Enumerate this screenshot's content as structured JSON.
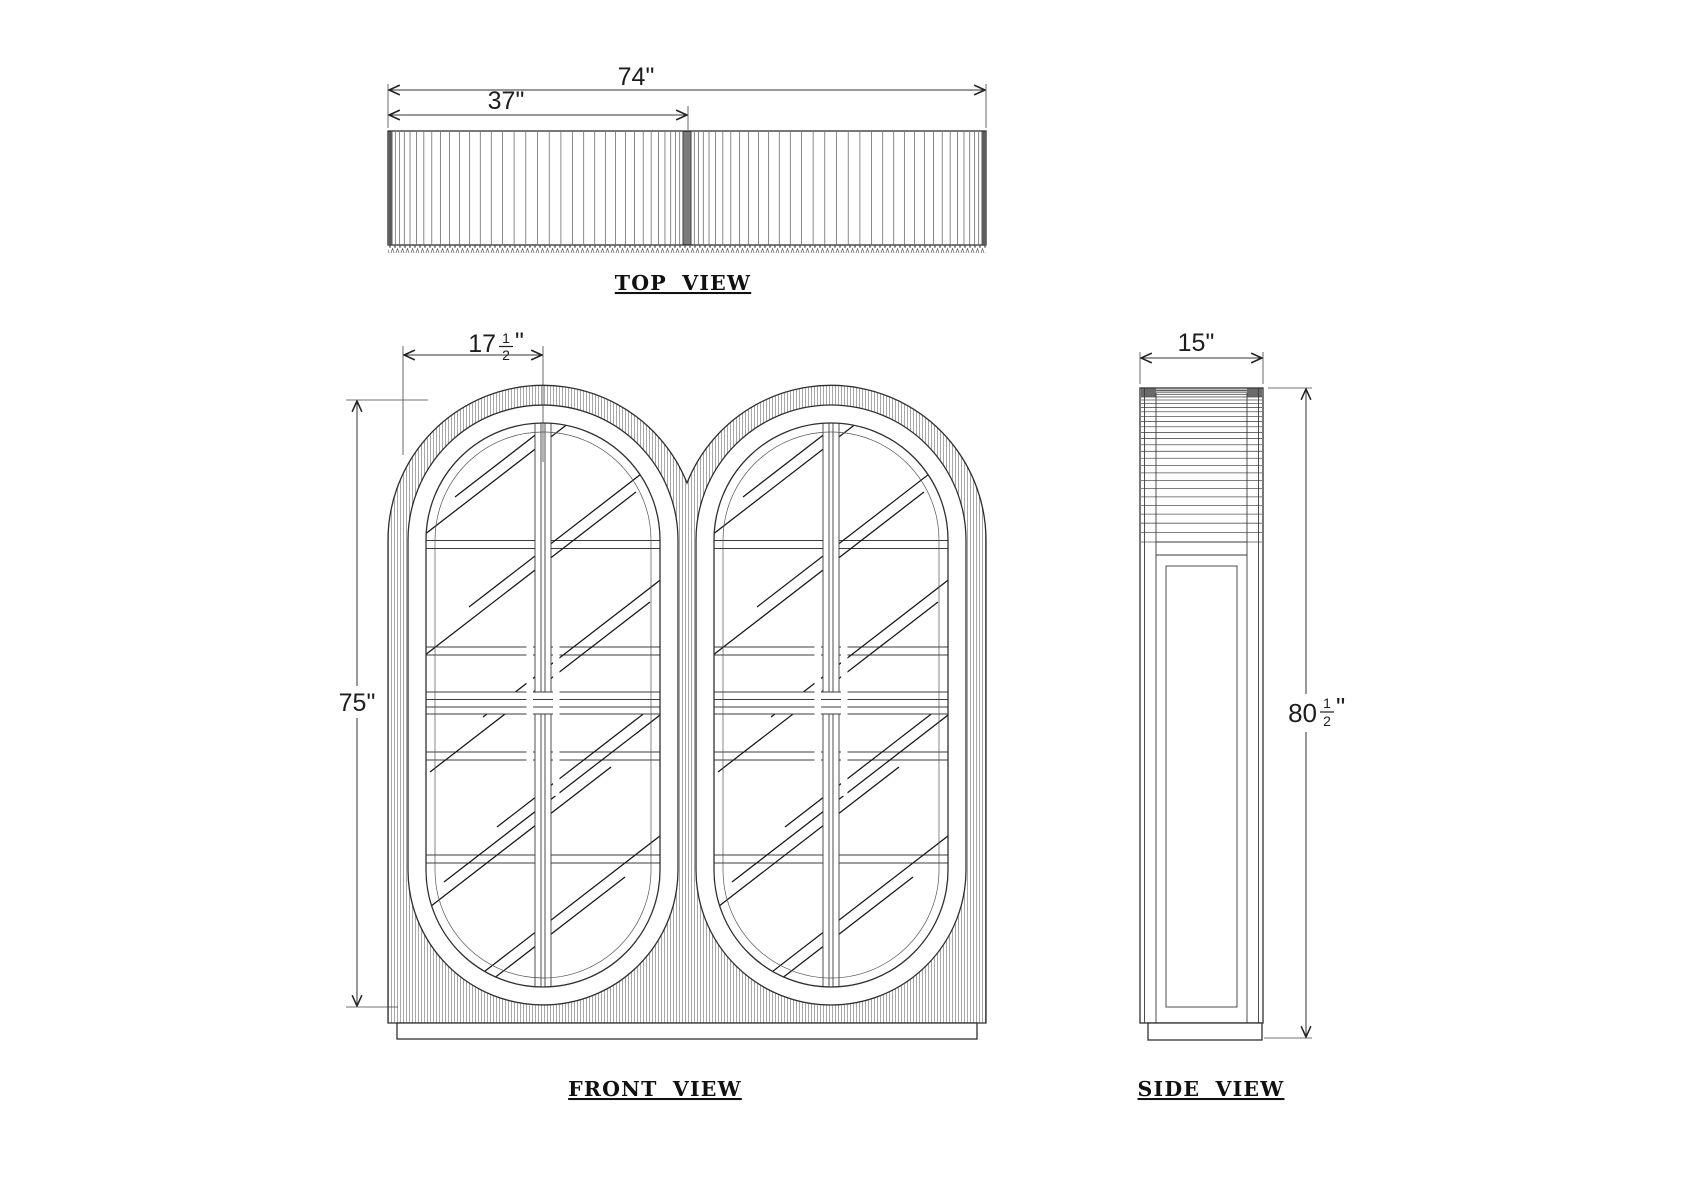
{
  "drawing": {
    "views": {
      "top_label": "TOP  VIEW",
      "front_label": "FRONT  VIEW",
      "side_label": "SIDE  VIEW"
    },
    "dimensions": {
      "top_total_width": "74\"",
      "top_half_width": "37\"",
      "front_door_width": {
        "whole": "17",
        "numerator": "1",
        "denominator": "2",
        "unit": "\""
      },
      "front_body_height": "75\"",
      "side_depth": "15\"",
      "side_total_height": {
        "whole": "80",
        "numerator": "1",
        "denominator": "2",
        "unit": "\""
      }
    },
    "line_color": "#2f2f2f",
    "paper_color": "#ffffff"
  }
}
